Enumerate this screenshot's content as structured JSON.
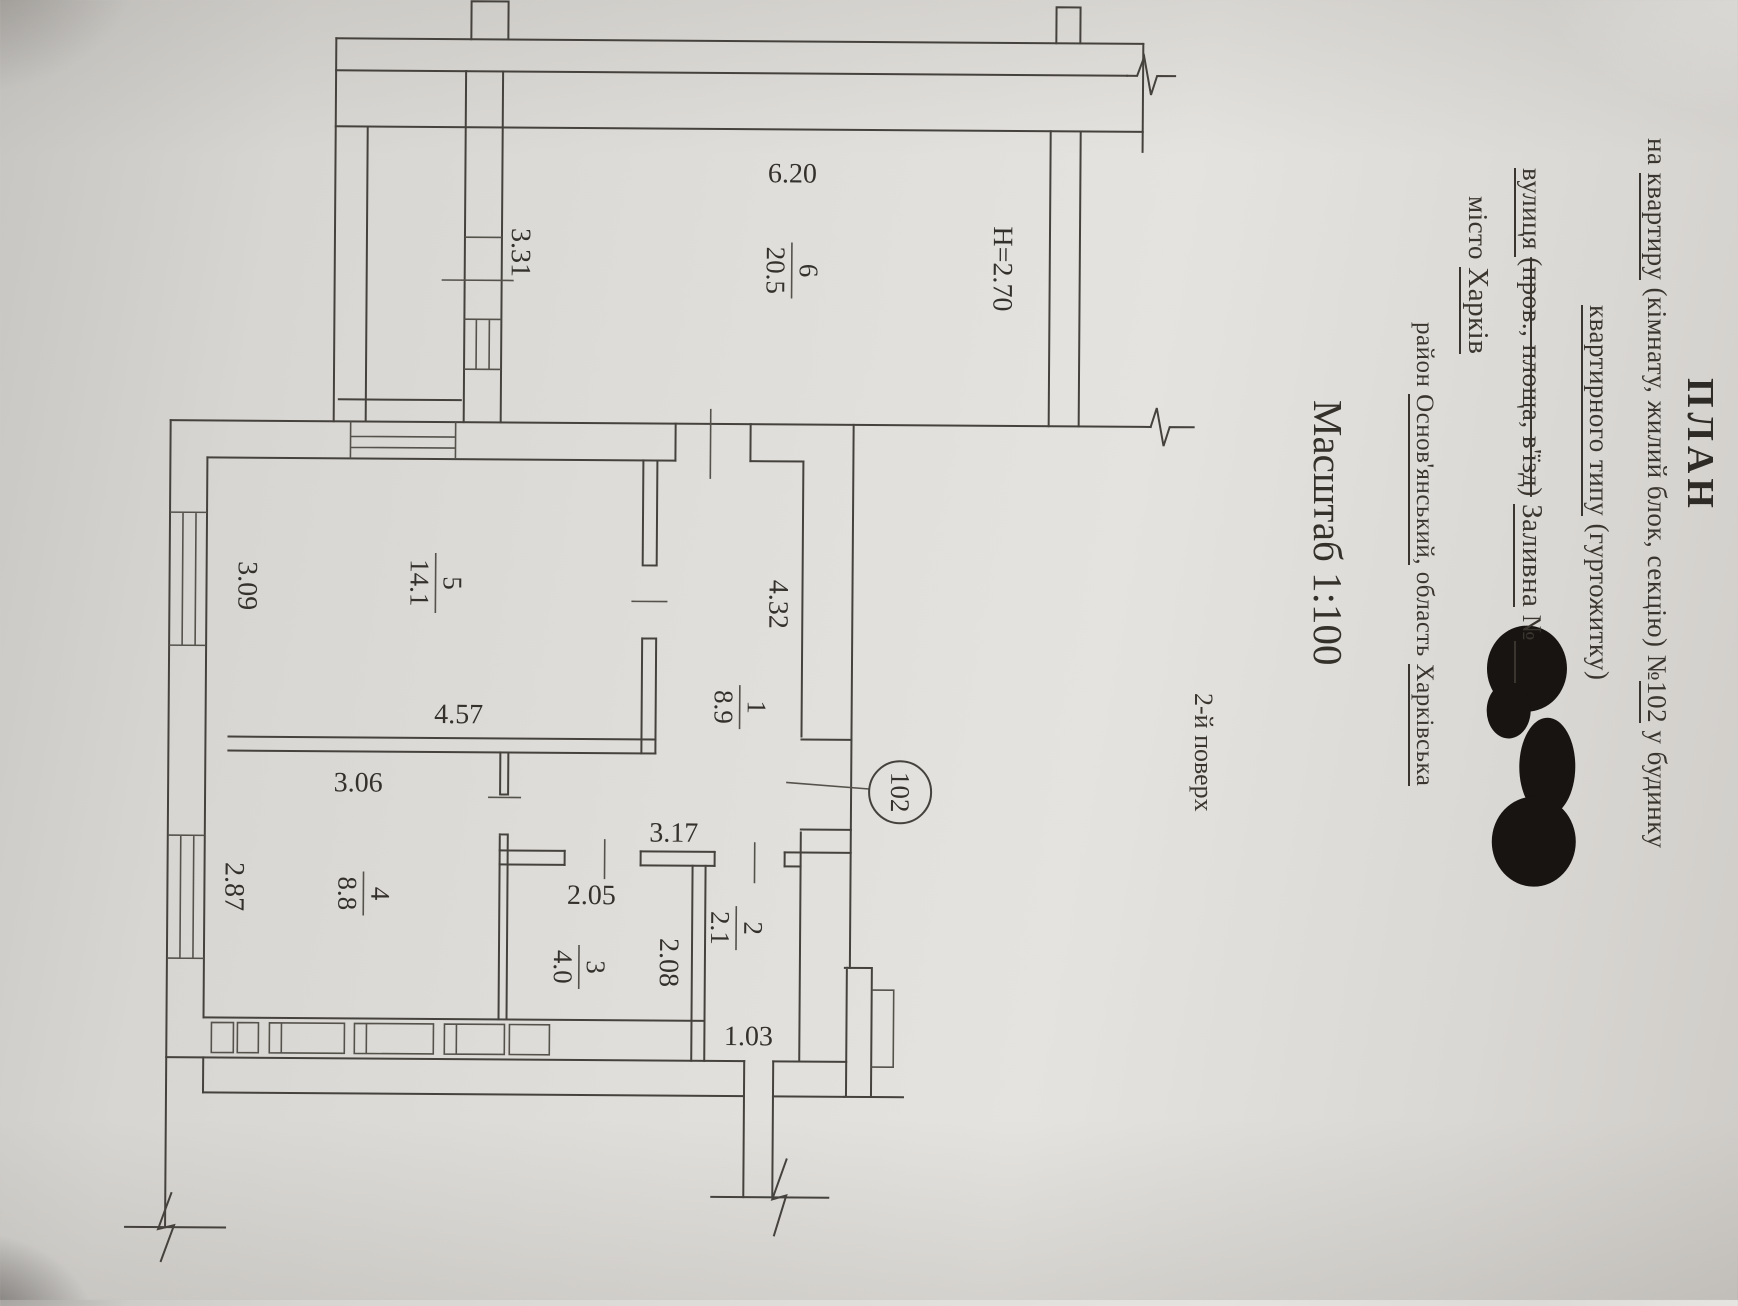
{
  "doc": {
    "title": "ПЛАН",
    "subject_prefix": "на ",
    "subject_kind": "квартиру",
    "subject_mid": " (кімнату, жилий блок, секцію) №",
    "subject_number": "102",
    "subject_tail": " у будинку",
    "type_main": "квартирного типу",
    "type_paren": " (гуртожитку)",
    "street_label": "вулиця ",
    "street_options": "(пров., площа, в'їзд)",
    "street_value": "Заливна",
    "number_sign": " №",
    "city_label": "місто ",
    "city_value": "Харків",
    "district_label": "район ",
    "district_value": "Основ'янський,",
    "region_label": "  область ",
    "region_value": "Харківська",
    "scale_text": "Масштаб 1:100",
    "floor_text": "2-й поверх"
  },
  "plan": {
    "apartment_number": "102",
    "ceiling_height": "H=2.70",
    "rooms": [
      {
        "num": "6",
        "area": "20.5"
      },
      {
        "num": "5",
        "area": "14.1"
      },
      {
        "num": "1",
        "area": "8.9"
      },
      {
        "num": "4",
        "area": "8.8"
      },
      {
        "num": "3",
        "area": "4.0"
      },
      {
        "num": "2",
        "area": "2.1"
      }
    ],
    "dims": {
      "w620": "6.20",
      "d331": "3.31",
      "d309": "3.09",
      "w457": "4.57",
      "d432": "4.32",
      "w306": "3.06",
      "d287": "2.87",
      "w317": "3.17",
      "w205": "2.05",
      "d208": "2.08",
      "w103": "1.03"
    }
  }
}
